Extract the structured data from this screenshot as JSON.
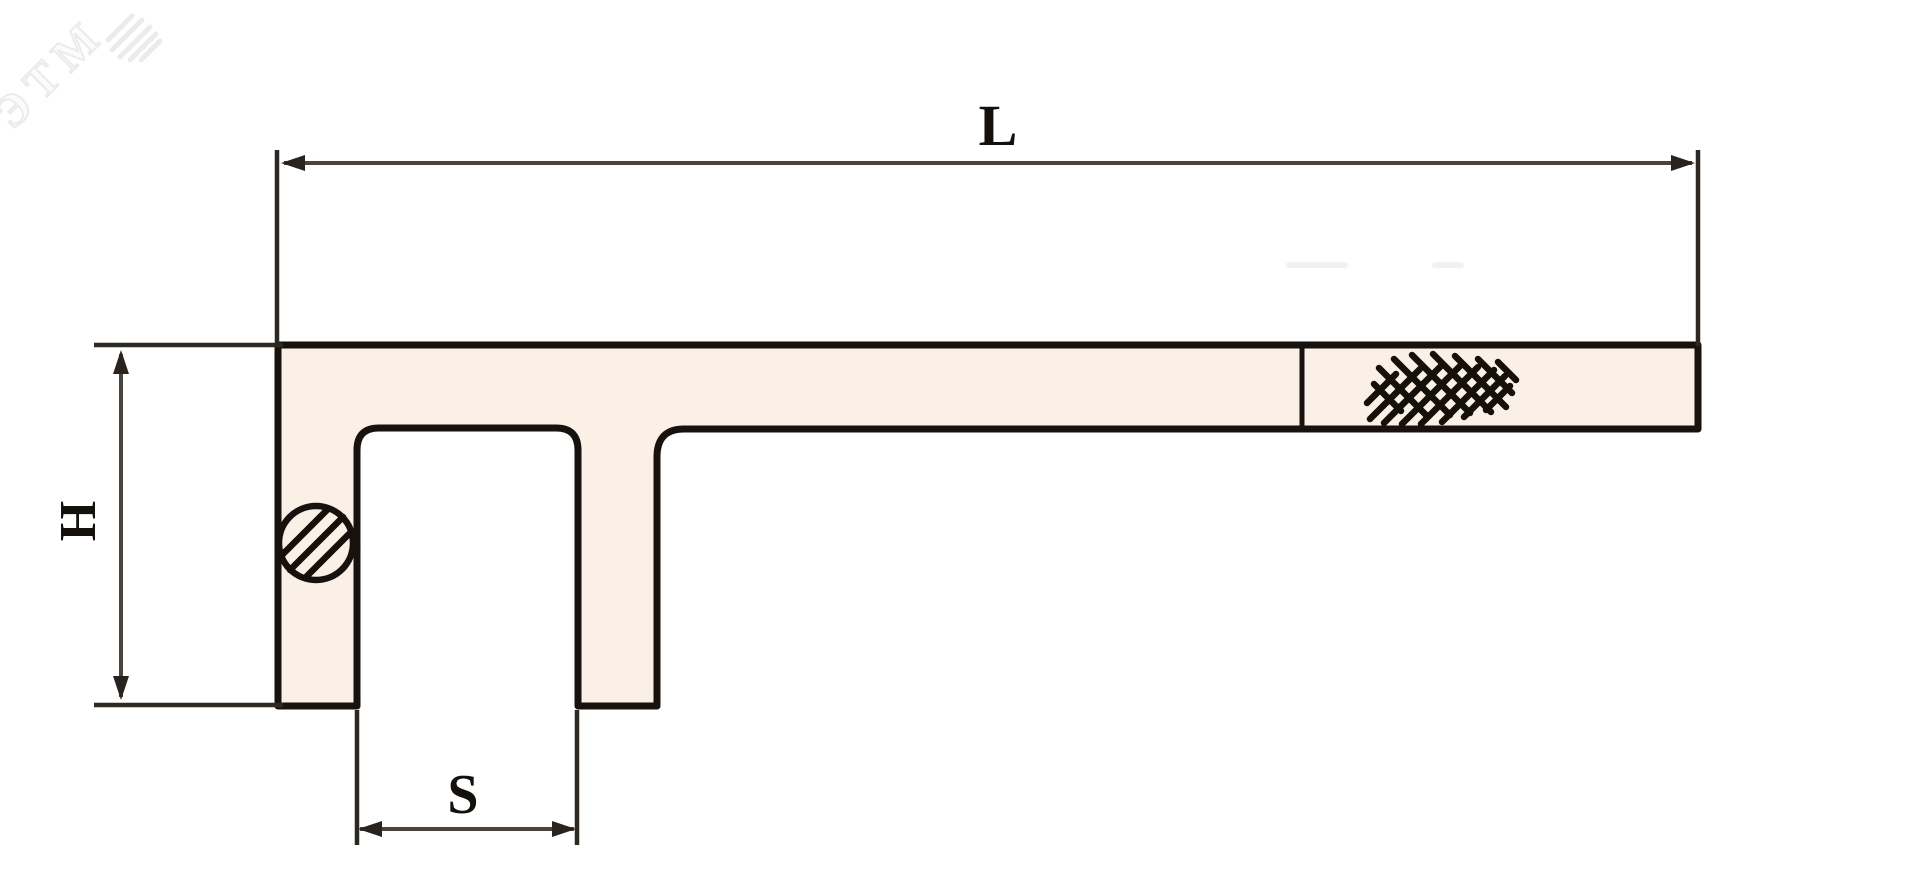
{
  "drawing": {
    "watermark_text": "ЭТМ",
    "dimension_labels": {
      "L": "L",
      "H": "H",
      "S": "S"
    },
    "dimensions": [
      {
        "symbol": "L",
        "measures": "overall length of handle bar",
        "orientation": "horizontal"
      },
      {
        "symbol": "H",
        "measures": "height of head section",
        "orientation": "vertical"
      },
      {
        "symbol": "S",
        "measures": "socket slot opening width",
        "orientation": "horizontal"
      }
    ],
    "features": [
      "body-outline-with-open-slot",
      "pin-circle-with-diagonal-hatching",
      "knurled-grip-crosshatch",
      "handle-divider-line"
    ],
    "colors": {
      "background": "#ffffff",
      "body_fill": "#fbf0e5",
      "outline": "#17120d",
      "dimension_line": "#4a423b",
      "extension_line": "#2e2823",
      "label_text": "#14100b",
      "watermark": "#edebe9"
    }
  }
}
